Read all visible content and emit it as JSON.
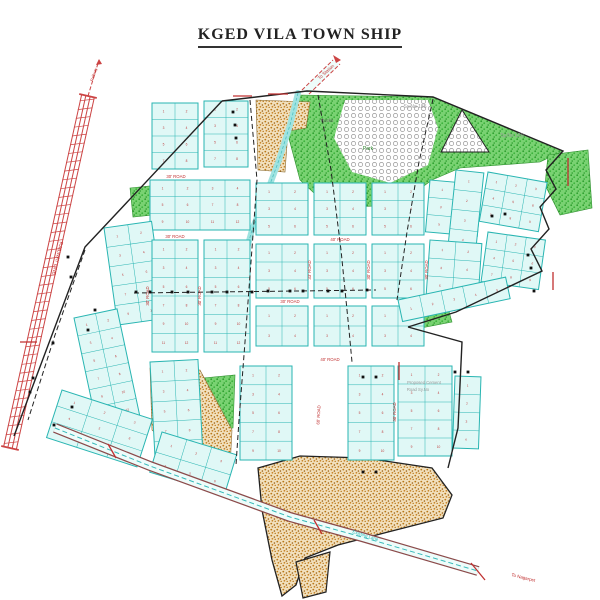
{
  "title": "KGED VILA TOWN SHIP",
  "map": {
    "colors": {
      "plot_fill": "#e0f8f6",
      "plot_stroke": "#29b5b2",
      "plot_number": "#c04040",
      "green_edge": "#2e8f2e",
      "sand_edge": "#8a6a30",
      "railway": "#cc4444",
      "road_edge": "#8b4a4a",
      "road_fill": "#eefcfa",
      "road_line": "#35b8b8",
      "boundary": "#222222",
      "label_red": "#c03030",
      "label_gray": "#9a9a9a",
      "stream": "#9fe3e0",
      "dot": "#111111"
    },
    "blocks": [
      [
        152,
        103,
        46,
        66,
        2,
        4,
        0
      ],
      [
        204,
        101,
        44,
        66,
        2,
        4,
        0
      ],
      [
        150,
        180,
        100,
        50,
        4,
        3,
        0
      ],
      [
        104,
        228,
        48,
        98,
        2,
        5,
        -8
      ],
      [
        152,
        240,
        46,
        112,
        2,
        6,
        0
      ],
      [
        204,
        240,
        46,
        112,
        2,
        6,
        0
      ],
      [
        74,
        318,
        44,
        110,
        2,
        6,
        -12
      ],
      [
        150,
        362,
        48,
        100,
        2,
        5,
        -3
      ],
      [
        62,
        390,
        95,
        50,
        3,
        3,
        18
      ],
      [
        162,
        432,
        78,
        42,
        3,
        2,
        17
      ],
      [
        256,
        183,
        52,
        52,
        2,
        3,
        0
      ],
      [
        314,
        183,
        52,
        52,
        2,
        3,
        0
      ],
      [
        372,
        183,
        52,
        52,
        2,
        3,
        0
      ],
      [
        430,
        180,
        52,
        52,
        2,
        3,
        5
      ],
      [
        488,
        172,
        60,
        50,
        3,
        3,
        10
      ],
      [
        456,
        170,
        28,
        118,
        1,
        6,
        6
      ],
      [
        256,
        244,
        52,
        54,
        2,
        3,
        0
      ],
      [
        314,
        244,
        52,
        54,
        2,
        3,
        0
      ],
      [
        372,
        244,
        52,
        54,
        2,
        3,
        0
      ],
      [
        430,
        240,
        52,
        54,
        2,
        3,
        4
      ],
      [
        488,
        232,
        58,
        50,
        3,
        3,
        8
      ],
      [
        256,
        306,
        52,
        40,
        2,
        2,
        0
      ],
      [
        314,
        306,
        52,
        40,
        2,
        2,
        0
      ],
      [
        372,
        306,
        52,
        40,
        2,
        2,
        0
      ],
      [
        398,
        300,
        110,
        22,
        5,
        1,
        -12
      ],
      [
        240,
        366,
        52,
        94,
        2,
        5,
        0
      ],
      [
        348,
        366,
        46,
        94,
        2,
        5,
        0
      ],
      [
        398,
        366,
        54,
        90,
        2,
        5,
        0
      ],
      [
        455,
        376,
        26,
        72,
        1,
        4,
        2
      ]
    ],
    "greens": [
      [
        [
          298,
          95
        ],
        [
          433,
          97
        ],
        [
          563,
          151
        ],
        [
          540,
          162
        ],
        [
          460,
          168
        ],
        [
          432,
          180
        ],
        [
          398,
          205
        ],
        [
          330,
          208
        ],
        [
          300,
          180
        ],
        [
          288,
          135
        ]
      ],
      [
        [
          548,
          155
        ],
        [
          588,
          150
        ],
        [
          592,
          208
        ],
        [
          560,
          215
        ],
        [
          545,
          185
        ]
      ],
      [
        [
          396,
          318
        ],
        [
          448,
          308
        ],
        [
          452,
          322
        ],
        [
          400,
          332
        ]
      ],
      [
        [
          130,
          188
        ],
        [
          150,
          186
        ],
        [
          153,
          215
        ],
        [
          133,
          217
        ]
      ],
      [
        [
          203,
          378
        ],
        [
          235,
          375
        ],
        [
          233,
          428
        ],
        [
          206,
          430
        ]
      ]
    ],
    "sands": [
      [
        [
          256,
          100
        ],
        [
          310,
          102
        ],
        [
          306,
          128
        ],
        [
          288,
          131
        ],
        [
          285,
          172
        ],
        [
          258,
          170
        ]
      ],
      [
        [
          150,
          368
        ],
        [
          200,
          370
        ],
        [
          232,
          430
        ],
        [
          230,
          468
        ],
        [
          200,
          472
        ],
        [
          152,
          430
        ]
      ],
      [
        [
          258,
          468
        ],
        [
          300,
          456
        ],
        [
          365,
          458
        ],
        [
          432,
          468
        ],
        [
          452,
          495
        ],
        [
          443,
          518
        ],
        [
          388,
          532
        ],
        [
          338,
          545
        ],
        [
          305,
          558
        ],
        [
          296,
          585
        ],
        [
          282,
          596
        ],
        [
          272,
          560
        ],
        [
          262,
          510
        ]
      ]
    ],
    "sand_tail": [
      [
        296,
        562
      ],
      [
        330,
        552
      ],
      [
        326,
        592
      ],
      [
        303,
        598
      ]
    ],
    "hills": [
      {
        "pts": [
          [
            345,
            100
          ],
          [
            428,
            100
          ],
          [
            438,
            128
          ],
          [
            428,
            165
          ],
          [
            390,
            183
          ],
          [
            352,
            172
          ],
          [
            334,
            138
          ]
        ],
        "outline": false
      },
      {
        "pts": [
          [
            462,
            110
          ],
          [
            441,
            152
          ],
          [
            489,
            152
          ]
        ],
        "outline": true
      }
    ],
    "stream": [
      [
        298,
        93
      ],
      [
        290,
        125
      ],
      [
        279,
        160
      ],
      [
        266,
        195
      ],
      [
        252,
        230
      ],
      [
        246,
        252
      ]
    ],
    "railway": {
      "x1": 88,
      "y1": 96,
      "x2": 10,
      "y2": 448,
      "ext": [
        [
          88,
          96
        ],
        [
          99,
          60
        ]
      ]
    },
    "top_road": {
      "fill": [
        [
          302,
          90
        ],
        [
          333,
          60
        ],
        [
          340,
          64
        ],
        [
          309,
          94
        ]
      ],
      "edges": [
        [
          [
            302,
            90
          ],
          [
            333,
            60
          ]
        ],
        [
          [
            309,
            94
          ],
          [
            340,
            64
          ]
        ]
      ]
    },
    "road": [
      [
        55,
        428
      ],
      [
        150,
        466
      ],
      [
        290,
        517
      ],
      [
        362,
        537
      ],
      [
        478,
        571
      ]
    ],
    "boundary_lines": [
      [
        [
          222,
          101
        ],
        [
          307,
          91
        ],
        [
          433,
          97
        ],
        [
          563,
          151
        ],
        [
          546,
          170
        ],
        [
          556,
          189
        ],
        [
          540,
          207
        ],
        [
          549,
          229
        ],
        [
          531,
          249
        ],
        [
          542,
          271
        ],
        [
          456,
          312
        ],
        [
          408,
          327
        ]
      ],
      [
        [
          408,
          327
        ],
        [
          462,
          342
        ],
        [
          458,
          428
        ],
        [
          448,
          468
        ]
      ],
      [
        [
          222,
          101
        ],
        [
          85,
          247
        ],
        [
          14,
          436
        ]
      ]
    ],
    "dashed_lines": [
      [
        [
          250,
          100
        ],
        [
          257,
          180
        ],
        [
          251,
          262
        ],
        [
          245,
          342
        ],
        [
          239,
          420
        ],
        [
          236,
          465
        ]
      ],
      [
        [
          318,
          95
        ],
        [
          331,
          170
        ],
        [
          341,
          250
        ],
        [
          349,
          330
        ],
        [
          352,
          362
        ]
      ],
      [
        [
          433,
          99
        ],
        [
          419,
          162
        ],
        [
          407,
          232
        ],
        [
          397,
          300
        ]
      ],
      [
        [
          85,
          250
        ],
        [
          55,
          335
        ],
        [
          28,
          420
        ]
      ],
      [
        [
          134,
          293
        ],
        [
          376,
          290
        ]
      ]
    ],
    "dots": [
      [
        136,
        292
      ],
      [
        150,
        292
      ],
      [
        172,
        292
      ],
      [
        188,
        292
      ],
      [
        212,
        292
      ],
      [
        227,
        292
      ],
      [
        252,
        292
      ],
      [
        268,
        291
      ],
      [
        290,
        291
      ],
      [
        303,
        291
      ],
      [
        328,
        291
      ],
      [
        342,
        291
      ],
      [
        367,
        290
      ],
      [
        233,
        112
      ],
      [
        235,
        125
      ],
      [
        236,
        138
      ],
      [
        68,
        257
      ],
      [
        71,
        277
      ],
      [
        53,
        343
      ],
      [
        33,
        378
      ],
      [
        30,
        392
      ],
      [
        72,
        407
      ],
      [
        54,
        425
      ],
      [
        95,
        310
      ],
      [
        88,
        330
      ],
      [
        528,
        255
      ],
      [
        531,
        268
      ],
      [
        534,
        291
      ],
      [
        363,
        377
      ],
      [
        376,
        377
      ],
      [
        363,
        472
      ],
      [
        376,
        472
      ],
      [
        455,
        372
      ],
      [
        468,
        372
      ],
      [
        492,
        216
      ],
      [
        505,
        214
      ]
    ],
    "dims": [
      [
        233,
        96,
        252,
        96
      ],
      [
        268,
        94,
        288,
        94
      ],
      [
        568,
        158,
        568,
        186
      ],
      [
        553,
        272,
        553,
        290
      ],
      [
        20,
        342,
        37,
        342
      ],
      [
        108,
        444,
        116,
        458
      ],
      [
        314,
        520,
        322,
        534
      ],
      [
        471,
        563,
        485,
        580
      ],
      [
        399,
        362,
        399,
        380
      ]
    ],
    "labels": [
      [
        "Sy.No 185",
        415,
        108,
        5,
        "#9a9a9a",
        0
      ],
      [
        "Sy.No 190",
        512,
        137,
        5,
        "#9a9a9a",
        0
      ],
      [
        "Rocks",
        327,
        122,
        4.5,
        "#666666",
        0
      ],
      [
        "Park",
        368,
        150,
        5,
        "#1e7a1e",
        0
      ],
      [
        "Proposed Cement",
        424,
        384,
        4.2,
        "#9a9a9a",
        0
      ],
      [
        "Road Sy.No",
        418,
        391,
        4.2,
        "#9a9a9a",
        0
      ],
      [
        "30' ROAD",
        176,
        178,
        4.3,
        "#c03030",
        0
      ],
      [
        "30' ROAD",
        175,
        238,
        4.3,
        "#c03030",
        0
      ],
      [
        "30' ROAD",
        149,
        296,
        4.3,
        "#c03030",
        -90
      ],
      [
        "30' ROAD",
        201,
        296,
        4.3,
        "#c03030",
        -90
      ],
      [
        "33' ROAD",
        311,
        270,
        4.3,
        "#c03030",
        -90
      ],
      [
        "30' ROAD",
        370,
        270,
        4.3,
        "#c03030",
        -90
      ],
      [
        "30' ROAD",
        428,
        270,
        4.3,
        "#c03030",
        -90
      ],
      [
        "40' ROAD",
        340,
        241,
        4.3,
        "#c03030",
        0
      ],
      [
        "30' ROAD",
        290,
        303,
        4.3,
        "#c03030",
        0
      ],
      [
        "40' ROAD",
        330,
        361,
        4.3,
        "#c03030",
        0
      ],
      [
        "60' ROAD",
        320,
        415,
        4.3,
        "#c03030",
        -87
      ],
      [
        "30' ROAD",
        396,
        412,
        4.3,
        "#c03030",
        -90
      ],
      [
        "RAILWAY LINE",
        56,
        258,
        5,
        "#c03030",
        103
      ],
      [
        "Railway",
        95,
        75,
        4,
        "#c03030",
        -72
      ],
      [
        "To Station",
        327,
        73,
        4.5,
        "#c03030",
        -42
      ],
      [
        "Existing Lane",
        365,
        537,
        4.5,
        "#2ab7b7",
        17
      ],
      [
        "To Nagarpet",
        523,
        579,
        4.5,
        "#c03030",
        14
      ]
    ]
  }
}
